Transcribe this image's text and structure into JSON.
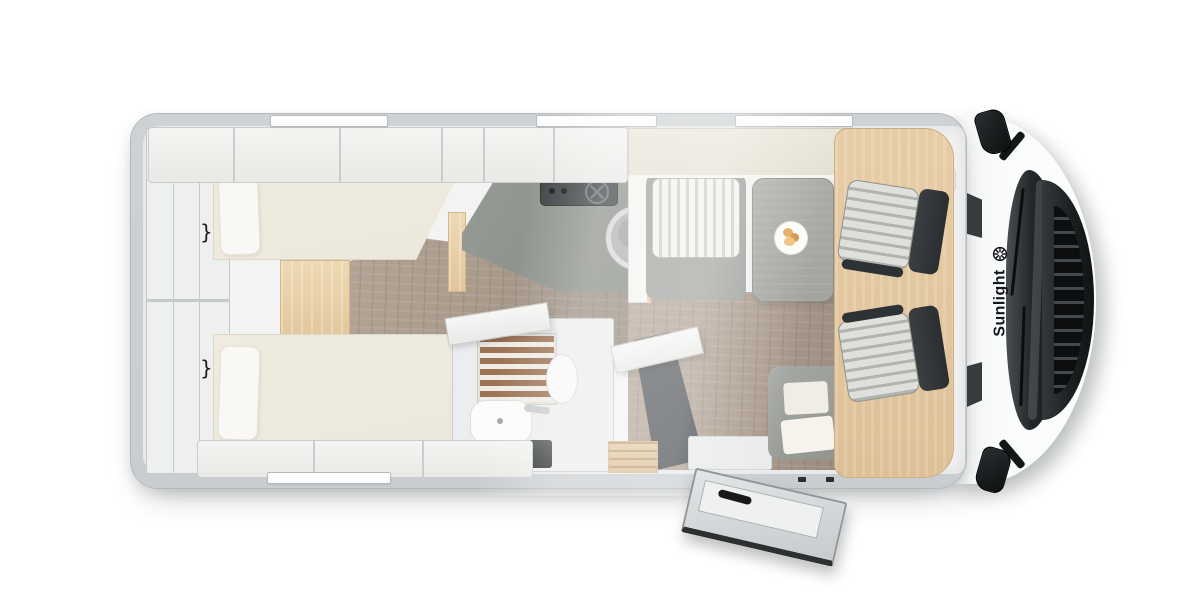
{
  "vehicle": {
    "brand_label": "Sunlight"
  },
  "icons": {
    "sun": "sun-icon",
    "reading_lamp_glyph": "}"
  },
  "colors": {
    "page_bg": "#ffffff",
    "wall": "#c9cdd0",
    "wall_edge": "#b4b9bc",
    "interior": "#f2f3f2",
    "cream": "#eae6da",
    "bed": "#ece8dc",
    "pillow": "#f9f8f4",
    "beech": "#e5cba4",
    "beech_light": "#eed9b3",
    "wood_floor": "#a99a8b",
    "counter": "#8e918c",
    "stove": "#3e4143",
    "table": "#a2a49f",
    "bench_base": "#9da09b",
    "stripe_light": "#f3f2ee",
    "stripe_dark": "#ccccc7",
    "dark_cabinet": "#53575a",
    "seat_dark": "#33373a",
    "seat_cushion": "#dfe0dc",
    "windshield": "#23272a",
    "grille": "#111314",
    "cab_white": "#fbfcfc",
    "brand_text": "#15151f",
    "slat_brown": "#9c7253",
    "plate_food": "#e2a95c"
  }
}
